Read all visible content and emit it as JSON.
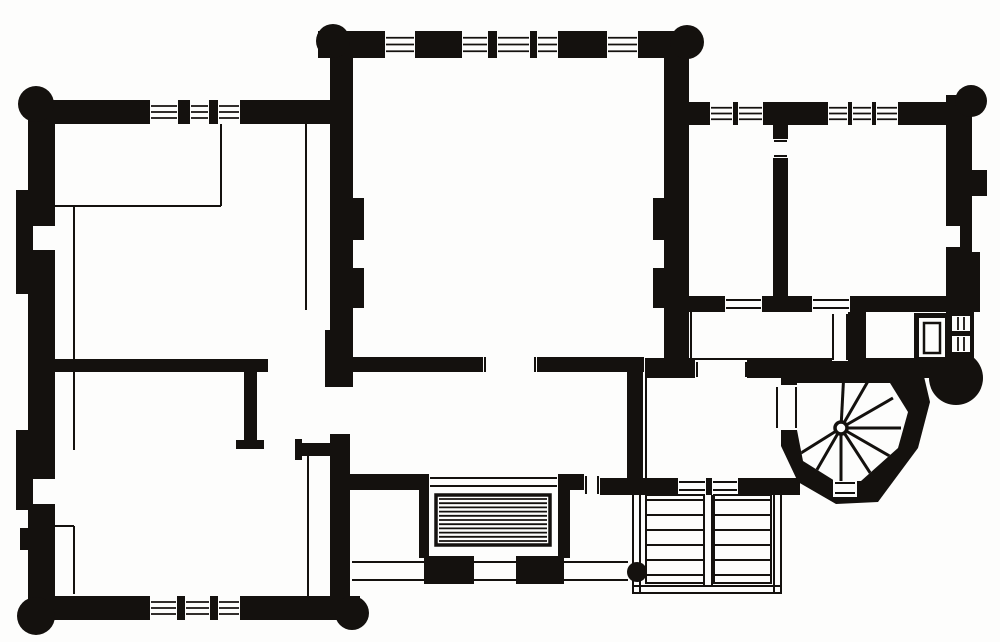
{
  "meta": {
    "type": "architectural-floor-plan",
    "description": "Black-and-white engraved floor plan of a house with corner turrets, central hall, spiral stair turret, terrace steps and external stair",
    "canvas": {
      "width": 1000,
      "height": 642,
      "background": "#fdfdfc",
      "ink": "#14110e"
    }
  },
  "plan": {
    "walls": [
      [
        30,
        100,
        303,
        24
      ],
      [
        28,
        118,
        27,
        482
      ],
      [
        16,
        190,
        14,
        104
      ],
      [
        16,
        430,
        16,
        80
      ],
      [
        20,
        528,
        10,
        22
      ],
      [
        55,
        359,
        213,
        13
      ],
      [
        244,
        372,
        13,
        72
      ],
      [
        236,
        440,
        28,
        9
      ],
      [
        28,
        596,
        332,
        24
      ],
      [
        330,
        434,
        20,
        166
      ],
      [
        300,
        443,
        32,
        13
      ],
      [
        295,
        439,
        7,
        21
      ],
      [
        318,
        31,
        372,
        27
      ],
      [
        330,
        58,
        23,
        276
      ],
      [
        325,
        330,
        28,
        57
      ],
      [
        352,
        198,
        12,
        42
      ],
      [
        352,
        268,
        12,
        40
      ],
      [
        325,
        357,
        159,
        15
      ],
      [
        537,
        357,
        107,
        15
      ],
      [
        664,
        58,
        25,
        302
      ],
      [
        653,
        198,
        12,
        42
      ],
      [
        653,
        268,
        12,
        40
      ],
      [
        688,
        102,
        270,
        23
      ],
      [
        773,
        125,
        15,
        14
      ],
      [
        773,
        158,
        15,
        142
      ],
      [
        946,
        95,
        26,
        217
      ],
      [
        972,
        170,
        15,
        26
      ],
      [
        946,
        252,
        34,
        60
      ],
      [
        688,
        296,
        270,
        16
      ],
      [
        848,
        312,
        18,
        50
      ],
      [
        645,
        358,
        310,
        20
      ],
      [
        940,
        358,
        30,
        28
      ],
      [
        914,
        313,
        36,
        49
      ],
      [
        946,
        310,
        28,
        52
      ],
      [
        627,
        358,
        16,
        137
      ],
      [
        627,
        478,
        173,
        17
      ],
      [
        419,
        474,
        10,
        84
      ],
      [
        348,
        474,
        72,
        16
      ],
      [
        558,
        474,
        12,
        84
      ],
      [
        570,
        474,
        14,
        16
      ],
      [
        600,
        478,
        28,
        17
      ],
      [
        424,
        556,
        50,
        28
      ],
      [
        516,
        556,
        48,
        28
      ]
    ],
    "turrets": [
      [
        36,
        104,
        18
      ],
      [
        36,
        616,
        19
      ],
      [
        333,
        41,
        17
      ],
      [
        687,
        42,
        17
      ],
      [
        971,
        101,
        16
      ],
      [
        352,
        613,
        17
      ],
      [
        956,
        378,
        27
      ]
    ],
    "openings": [
      {
        "r": [
          33,
          224,
          22,
          28
        ],
        "lines": [
          [
            33,
            225,
            55,
            225
          ],
          [
            33,
            251,
            55,
            251
          ]
        ]
      },
      {
        "r": [
          33,
          477,
          22,
          29
        ],
        "lines": [
          [
            33,
            478,
            55,
            478
          ],
          [
            33,
            505,
            55,
            505
          ]
        ]
      },
      {
        "r": [
          946,
          224,
          14,
          25
        ],
        "lines": [
          [
            946,
            225,
            960,
            225
          ],
          [
            946,
            248,
            960,
            248
          ]
        ]
      },
      {
        "r": [
          483,
          357,
          54,
          15
        ],
        "lines": [
          [
            485,
            357,
            485,
            372
          ],
          [
            535,
            357,
            535,
            372
          ]
        ]
      },
      {
        "r": [
          695,
          360,
          52,
          18
        ],
        "lines": [
          [
            697,
            362,
            697,
            377
          ],
          [
            746,
            362,
            746,
            377
          ]
        ]
      },
      {
        "r": [
          725,
          296,
          37,
          16
        ],
        "lines": [
          [
            726,
            300,
            761,
            300
          ],
          [
            726,
            308,
            761,
            308
          ]
        ]
      },
      {
        "r": [
          812,
          296,
          38,
          16
        ],
        "lines": [
          [
            813,
            300,
            849,
            300
          ],
          [
            813,
            308,
            849,
            308
          ]
        ]
      },
      {
        "r": [
          773,
          139,
          15,
          19
        ],
        "lines": [
          [
            774,
            141,
            787,
            141
          ],
          [
            774,
            156,
            787,
            156
          ]
        ]
      },
      {
        "r": [
          832,
          313,
          16,
          48
        ],
        "lines": [
          [
            833,
            314,
            833,
            360
          ],
          [
            847,
            314,
            847,
            360
          ]
        ]
      },
      {
        "r": [
          775,
          385,
          23,
          45
        ],
        "lines": [
          [
            777,
            387,
            777,
            428
          ],
          [
            796,
            387,
            796,
            428
          ]
        ]
      },
      {
        "r": [
          833,
          479,
          24,
          18
        ],
        "lines": [
          [
            835,
            483,
            855,
            483
          ],
          [
            835,
            493,
            855,
            493
          ]
        ]
      },
      {
        "r": [
          429,
          474,
          129,
          16
        ],
        "lines": [
          [
            430,
            478,
            557,
            478
          ],
          [
            430,
            486,
            557,
            486
          ]
        ]
      },
      {
        "r": [
          584,
          474,
          16,
          21
        ],
        "lines": [
          [
            586,
            476,
            586,
            494
          ],
          [
            598,
            476,
            598,
            494
          ]
        ]
      },
      {
        "r": [
          678,
          478,
          28,
          17
        ],
        "lines": [
          [
            679,
            482,
            705,
            482
          ],
          [
            679,
            490,
            705,
            490
          ]
        ]
      },
      {
        "r": [
          712,
          478,
          26,
          17
        ],
        "lines": [
          [
            713,
            482,
            737,
            482
          ],
          [
            713,
            490,
            737,
            490
          ]
        ]
      },
      {
        "r": [
          919,
          318,
          26,
          39
        ],
        "lines": []
      }
    ],
    "windows": [
      {
        "r": [
          150,
          100,
          28,
          24
        ],
        "o": "h",
        "n": 3
      },
      {
        "r": [
          190,
          100,
          19,
          24
        ],
        "o": "h",
        "n": 3
      },
      {
        "r": [
          218,
          100,
          22,
          24
        ],
        "o": "h",
        "n": 3
      },
      {
        "r": [
          385,
          31,
          30,
          27
        ],
        "o": "h",
        "n": 3
      },
      {
        "r": [
          462,
          31,
          26,
          27
        ],
        "o": "h",
        "n": 3
      },
      {
        "r": [
          497,
          31,
          33,
          27
        ],
        "o": "h",
        "n": 3
      },
      {
        "r": [
          537,
          31,
          21,
          27
        ],
        "o": "h",
        "n": 3
      },
      {
        "r": [
          607,
          31,
          31,
          27
        ],
        "o": "h",
        "n": 3
      },
      {
        "r": [
          710,
          102,
          23,
          23
        ],
        "o": "h",
        "n": 3
      },
      {
        "r": [
          738,
          102,
          25,
          23
        ],
        "o": "h",
        "n": 3
      },
      {
        "r": [
          828,
          102,
          20,
          23
        ],
        "o": "h",
        "n": 3
      },
      {
        "r": [
          852,
          102,
          20,
          23
        ],
        "o": "h",
        "n": 3
      },
      {
        "r": [
          876,
          102,
          22,
          23
        ],
        "o": "h",
        "n": 3
      },
      {
        "r": [
          150,
          596,
          27,
          24
        ],
        "o": "h",
        "n": 3
      },
      {
        "r": [
          185,
          596,
          25,
          24
        ],
        "o": "h",
        "n": 3
      },
      {
        "r": [
          218,
          596,
          22,
          24
        ],
        "o": "h",
        "n": 3
      },
      {
        "r": [
          952,
          316,
          18,
          15
        ],
        "o": "v",
        "n": 2
      },
      {
        "r": [
          952,
          336,
          18,
          16
        ],
        "o": "v",
        "n": 2
      }
    ],
    "thin_lines": [
      [
        306,
        124,
        306,
        310
      ],
      [
        221,
        124,
        221,
        206
      ],
      [
        55,
        206,
        221,
        206
      ],
      [
        74,
        206,
        74,
        360
      ],
      [
        74,
        372,
        74,
        450
      ],
      [
        55,
        526,
        74,
        526
      ],
      [
        74,
        526,
        74,
        594
      ],
      [
        308,
        450,
        308,
        596
      ],
      [
        691,
        312,
        691,
        358
      ],
      [
        646,
        372,
        646,
        478
      ],
      [
        352,
        562,
        424,
        562
      ],
      [
        352,
        580,
        424,
        580
      ],
      [
        474,
        562,
        516,
        562
      ],
      [
        474,
        580,
        516,
        580
      ],
      [
        564,
        562,
        628,
        562
      ],
      [
        564,
        580,
        628,
        580
      ]
    ],
    "spiral": {
      "outer": [
        [
          781,
          368
        ],
        [
          922,
          368
        ],
        [
          930,
          402
        ],
        [
          918,
          448
        ],
        [
          878,
          502
        ],
        [
          836,
          504
        ],
        [
          798,
          482
        ],
        [
          781,
          446
        ]
      ],
      "inner": [
        [
          797,
          383
        ],
        [
          890,
          383
        ],
        [
          908,
          412
        ],
        [
          898,
          448
        ],
        [
          861,
          481
        ],
        [
          835,
          481
        ],
        [
          803,
          461
        ],
        [
          797,
          430
        ]
      ],
      "center": [
        841,
        428
      ],
      "newel_r": 6,
      "tread_len": 60,
      "tread_angles": [
        -87,
        -60,
        -30,
        0,
        30,
        57,
        90,
        120,
        148
      ]
    },
    "steps_hatched": {
      "frame": [
        436,
        495,
        114,
        50
      ],
      "inset": 4,
      "n_lines": 11
    },
    "ext_stair": {
      "borders": [
        [
          633,
          495,
          633,
          594
        ],
        [
          640,
          495,
          640,
          594
        ],
        [
          774,
          495,
          774,
          594
        ],
        [
          781,
          495,
          781,
          594
        ],
        [
          633,
          586,
          781,
          586
        ],
        [
          633,
          593,
          781,
          593
        ],
        [
          704,
          495,
          704,
          586
        ],
        [
          712,
          495,
          712,
          586
        ]
      ],
      "flights": [
        [
          646,
          495,
          58,
          88
        ],
        [
          714,
          495,
          57,
          88
        ]
      ],
      "tread_ys": [
        500,
        515,
        530,
        545,
        560,
        575
      ]
    },
    "fixture_inner": [
      924,
      323,
      16,
      30
    ],
    "dots": [
      [
        637,
        572,
        10
      ]
    ]
  }
}
